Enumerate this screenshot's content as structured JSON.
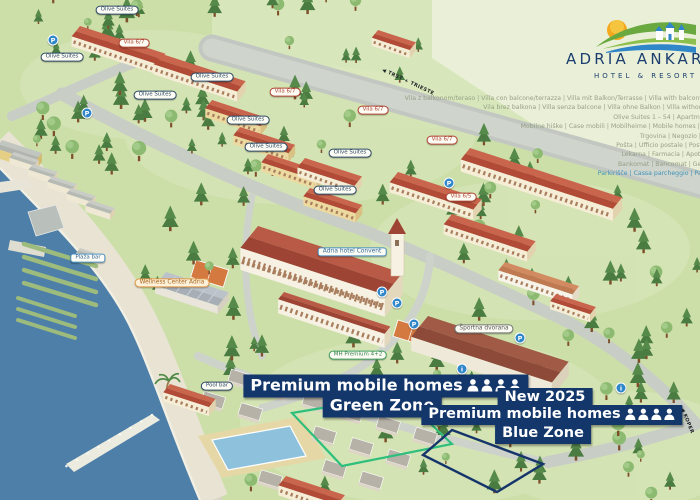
{
  "logo": {
    "title": "ADRIA ANKARAN",
    "subtitle": "HOTEL & RESORT"
  },
  "legend": {
    "lines": [
      {
        "text": "Vila z balkonom/teraso | Villa con balcone/terrazza | Villa mit Balkon/Terrasse | Villa with balcony/terrace 46 – 69"
      },
      {
        "text": "Vila brez balkona | Villa senza balcone | Villa ohne Balkon | Villa without balcony 1 – 45"
      },
      {
        "text": "Olive Suites 1 – 54 | Apartma Ankaran 1 – 20"
      },
      {
        "text": "Mobilne hiške | Case mobili | Mobilheime | Mobile homes | Premium homes"
      },
      {
        "text": "Trgovina | Negozio | Geschäft | Shop"
      },
      {
        "text": "Pošta | Ufficio postale | Postamt | Post office"
      },
      {
        "text": "Lekarna | Farmacia | Apotheke | Pharmacy"
      },
      {
        "text": "Bankomat | Bancomat | Geldautomat | ATM"
      },
      {
        "text": "Parkirišče | Cassa parcheggio | Parkplatz | Parking",
        "color": "#3e93b8"
      }
    ]
  },
  "road_signs": [
    {
      "text": "◀ TRST + TRIESTE"
    },
    {
      "text": "◀ KOPER"
    }
  ],
  "zones": {
    "green": {
      "title": "Premium mobile homes",
      "zone": "Green Zone",
      "occupancy_icons": 4
    },
    "blue": {
      "badge": "New 2025",
      "title": "Premium mobile homes",
      "zone": "Blue  Zone",
      "occupancy_icons": 4
    }
  },
  "map_labels": [
    {
      "text": "Olive Suites"
    },
    {
      "text": "Vila 6/7"
    },
    {
      "text": "Olive Suites"
    },
    {
      "text": "Olive Suites"
    },
    {
      "text": "Olive Suites"
    },
    {
      "text": "Vila 6/7"
    },
    {
      "text": "Vila 6/7"
    },
    {
      "text": "Vila 6/7"
    },
    {
      "text": "Olive Suites"
    },
    {
      "text": "Olive Suites"
    },
    {
      "text": "Olive Suites"
    },
    {
      "text": "Olive Suites"
    },
    {
      "text": "Vila 6/5"
    },
    {
      "text": "Adria hotel Convent"
    },
    {
      "text": "Wellness Center Adria"
    },
    {
      "text": "Športna dvorana"
    },
    {
      "text": "MH Premium 4+2"
    },
    {
      "text": "Pool bar"
    },
    {
      "text": "Plaža bar"
    }
  ],
  "icons": {
    "parking": "P",
    "info": "i"
  },
  "colors": {
    "sea": "#4d7fa8",
    "grass": "#ccdfa9",
    "roof": "#b14a36",
    "zone_label_bg": "#14376b",
    "green_outline": "#2fbf7d",
    "blue_outline": "#16356b"
  }
}
